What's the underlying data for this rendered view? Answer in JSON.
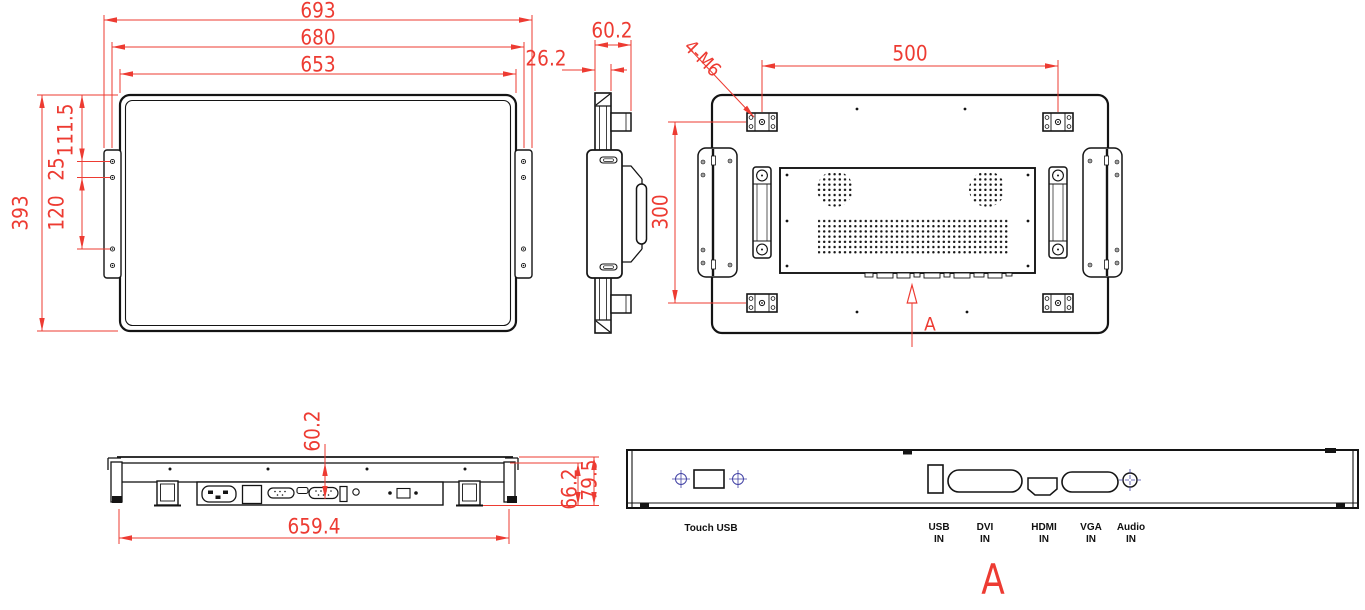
{
  "drawing": {
    "colors": {
      "line": "#141414",
      "dimension": "#ed3b32",
      "centerline": "#4343a5",
      "background": "#ffffff"
    },
    "front_view": {
      "dim_width_overall": "693",
      "dim_width_bezel": "680",
      "dim_width_panel": "653",
      "dim_height": "393",
      "dim_top_to_hole": "111.5",
      "dim_hole_pair": "25",
      "dim_hole_span": "120"
    },
    "side_view": {
      "dim_panel_depth": "26.2",
      "dim_total_depth": "60.2"
    },
    "back_view": {
      "dim_vesa_width": "500",
      "dim_vesa_height": "300",
      "label_thread": "4-M6",
      "section_label": "A"
    },
    "bottom_view": {
      "dim_depth": "60.2",
      "dim_width": "659.4",
      "dim_height_inner": "66.2",
      "dim_height_outer": "79.5"
    },
    "detail_view": {
      "section_label": "A",
      "ports": {
        "touch_usb": "Touch USB",
        "usb": {
          "l1": "USB",
          "l2": "IN"
        },
        "dvi": {
          "l1": "DVI",
          "l2": "IN"
        },
        "hdmi": {
          "l1": "HDMI",
          "l2": "IN"
        },
        "vga": {
          "l1": "VGA",
          "l2": "IN"
        },
        "audio": {
          "l1": "Audio",
          "l2": "IN"
        }
      }
    }
  }
}
